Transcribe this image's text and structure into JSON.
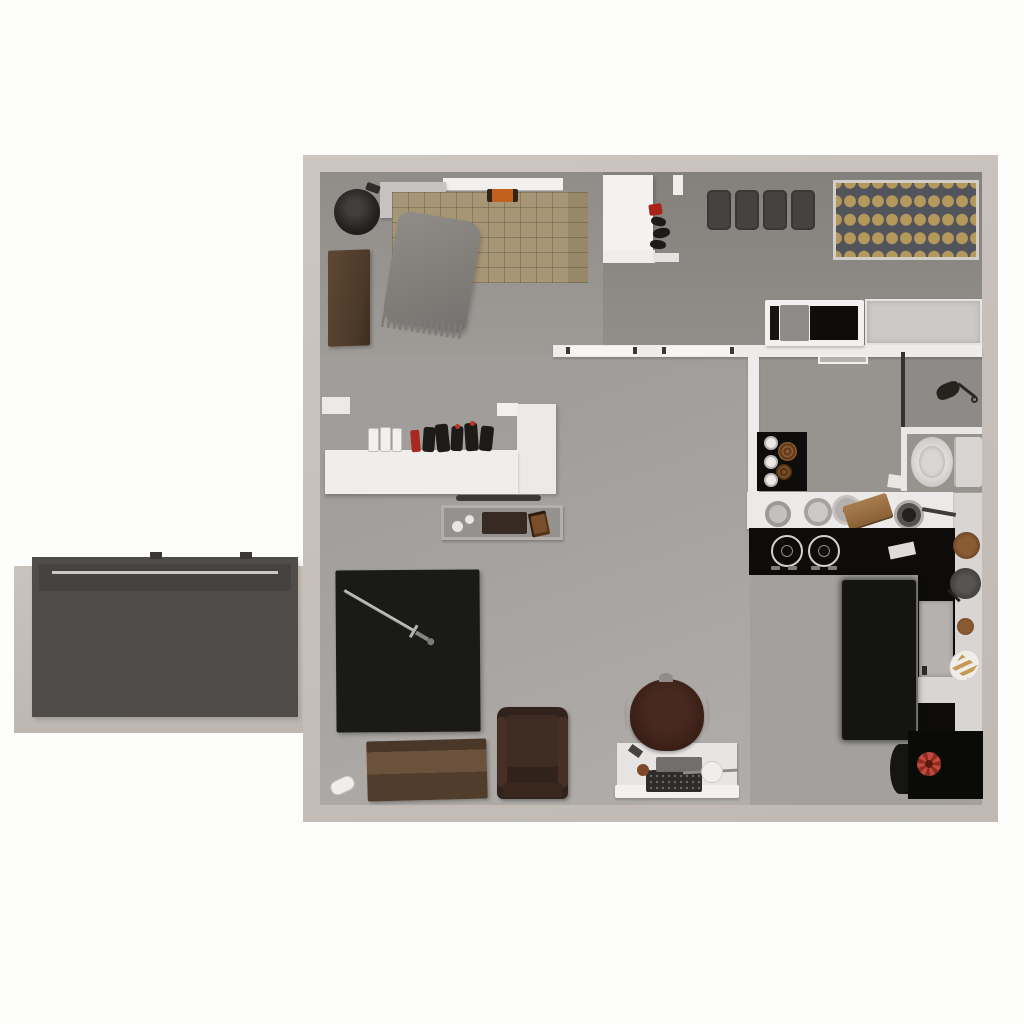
{
  "scene": {
    "type": "3d-floorplan-top-down-render",
    "description": "Top-down 3D render of a studio apartment floor plan with an external staircase annex on the left; no visible text in the image",
    "text_visible": "none"
  },
  "palette": {
    "page_background": "#fdfdfc",
    "outer_wall_beige": "#c8c1bb",
    "inner_wall_white": "#eeecea",
    "floor_living": "#a7a4a1",
    "floor_bedroom": "#9a9793",
    "floor_dining": "#8b8884",
    "kitchen_counter_black": "#0d0c0b",
    "mattress_tan": "#a69676",
    "accent_orange": "#c2601d",
    "accent_red": "#b03026",
    "wood_brown": "#5d4633",
    "gold_dots": "#b5985c",
    "stair_gray": "#6e6b69"
  },
  "rooms": {
    "bedroom": {
      "label": "Bedroom (top left)"
    },
    "entry": {
      "label": "Entry foyer with closet"
    },
    "dining": {
      "label": "Dining room (top right)"
    },
    "bathroom": {
      "label": "Bathroom with shower and toilet"
    },
    "kitchen": {
      "label": "Kitchen (right)"
    },
    "living": {
      "label": "Living area (bottom left)"
    },
    "annex": {
      "label": "External staircase annex"
    }
  },
  "stairs": {
    "label": "External staircase",
    "steps": 10,
    "landing": "dark top landing with light railing"
  },
  "furniture": {
    "pouf": {
      "label": "Round black pouf",
      "color": "#232221"
    },
    "wardrobe": {
      "label": "Wooden wardrobe",
      "color": "#4c3929"
    },
    "bed": {
      "label": "Quilted tan double bed",
      "color": "#a69676"
    },
    "pillow": {
      "label": "Orange pillow",
      "color": "#c2601d"
    },
    "blanket": {
      "label": "Draped gray throw blanket",
      "color": "#827f7b"
    },
    "platform": {
      "label": "Gray bedside platform",
      "color": "#c6c3c0"
    },
    "beam": {
      "label": "White wall shelf over bed",
      "color": "#f2f0ee"
    },
    "closet": {
      "label": "White entry closet",
      "color": "#f4f2f0"
    },
    "shoes": {
      "label": "Shoes and red jacket in entry niche"
    },
    "dining_stools": {
      "label": "Four dark dining stools",
      "color": "#454341"
    },
    "gold_tray": {
      "label": "Rack with rows of gold canisters",
      "color": "#b5985c"
    },
    "daybed": {
      "label": "White-frame daybed with black mattress",
      "color": "#0e0d0c"
    },
    "dresser": {
      "label": "Low gray dresser",
      "color": "#ccc9c6"
    },
    "shower": {
      "label": "Shower stall with dark glass panel"
    },
    "toilet": {
      "label": "Toilet with tank",
      "color": "#d7d4d1"
    },
    "towel_mat": {
      "label": "Black bath mat with towel rolls"
    },
    "bar_counter": {
      "label": "White L-shaped bar counter",
      "color": "#f0eeec"
    },
    "bottles": {
      "label": "Row of bottles and cups on bar"
    },
    "coffee_table": {
      "label": "Framed tray table with board and book"
    },
    "living_rug": {
      "label": "Large black area rug",
      "color": "#1a1a19"
    },
    "sword": {
      "label": "Decorative sword on rug",
      "color": "#b5b3b1"
    },
    "chest": {
      "label": "Wooden storage chest",
      "color": "#5f4834"
    },
    "armchair": {
      "label": "Dark leather armchair",
      "color": "#31231c"
    },
    "paper_roll": {
      "label": "White paper roll on floor"
    },
    "office_chair": {
      "label": "Brown leather office chair",
      "color": "#3a241c"
    },
    "desk": {
      "label": "White desk with typewriter and tray"
    },
    "kitchen_counter": {
      "label": "Kitchen counter with pots, pan and cutting board"
    },
    "stove": {
      "label": "Black two-burner stove",
      "color": "#0d0c0b"
    },
    "fridge": {
      "label": "Under-counter appliance",
      "color": "#b4b1ae"
    },
    "kitchen_rug": {
      "label": "Black kitchen runner rug",
      "color": "#141413"
    },
    "bar_stools": {
      "label": "Round kitchen stools",
      "color": "#8a5c34"
    },
    "pastry_plate": {
      "label": "Oval plate with pastries"
    },
    "corner_table": {
      "label": "Black corner table with red flower",
      "color": "#bf4a3c"
    }
  }
}
